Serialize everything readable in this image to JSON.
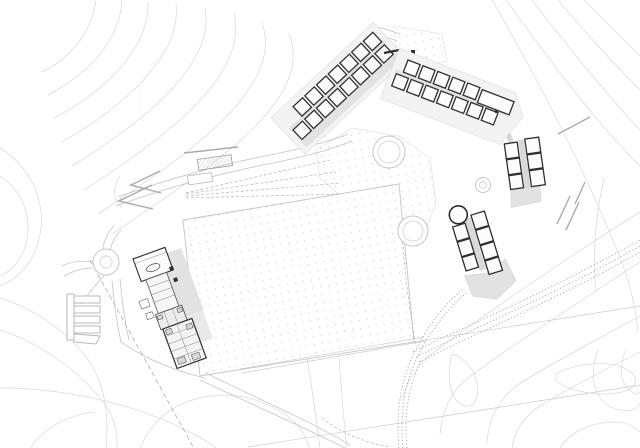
{
  "document": {
    "kind": "architectural-site-plan",
    "visible_text": [],
    "background": "#ffffff"
  },
  "colors": {
    "paper": "#ffffff",
    "contour": "#dadada",
    "road": "#c5c5c5",
    "dotted": "#a5a5a5",
    "paving": "#e2e2e2",
    "wall": "#2f2f2f",
    "dot": "#c9c9c9"
  },
  "site": {
    "central_field": {
      "shape": "rotated-rectangle",
      "texture": "dot-grid",
      "border": "thin-gray"
    },
    "main_building": {
      "features": [
        "oval-hall",
        "corridor",
        "terrace-deck",
        "dense-room-wing",
        "two-kiosks"
      ]
    },
    "clusters": [
      {
        "id": "northwest-chain",
        "orientation_deg": -43,
        "row_unit_counts": [
          7,
          8
        ]
      },
      {
        "id": "north-chain",
        "orientation_deg": 21,
        "row_unit_counts": [
          5,
          7
        ],
        "extra": "long-hall"
      },
      {
        "id": "east-upper-block",
        "rooms": 6,
        "courtyard": true
      },
      {
        "id": "east-lower-block",
        "rooms": 7,
        "tower": "round",
        "plaza": true
      }
    ],
    "circulation": {
      "roundabout": true,
      "parking_bays": 5,
      "dotted_road_band": true,
      "retaining_chevrons": 2,
      "ramp_sightlines": 4,
      "ponds_double_ring": 3
    },
    "terrain": {
      "contour_lines": true,
      "regions": [
        "top-left-hill",
        "top-right-slope",
        "bottom-right-valley",
        "bottom-left-slope"
      ]
    }
  }
}
